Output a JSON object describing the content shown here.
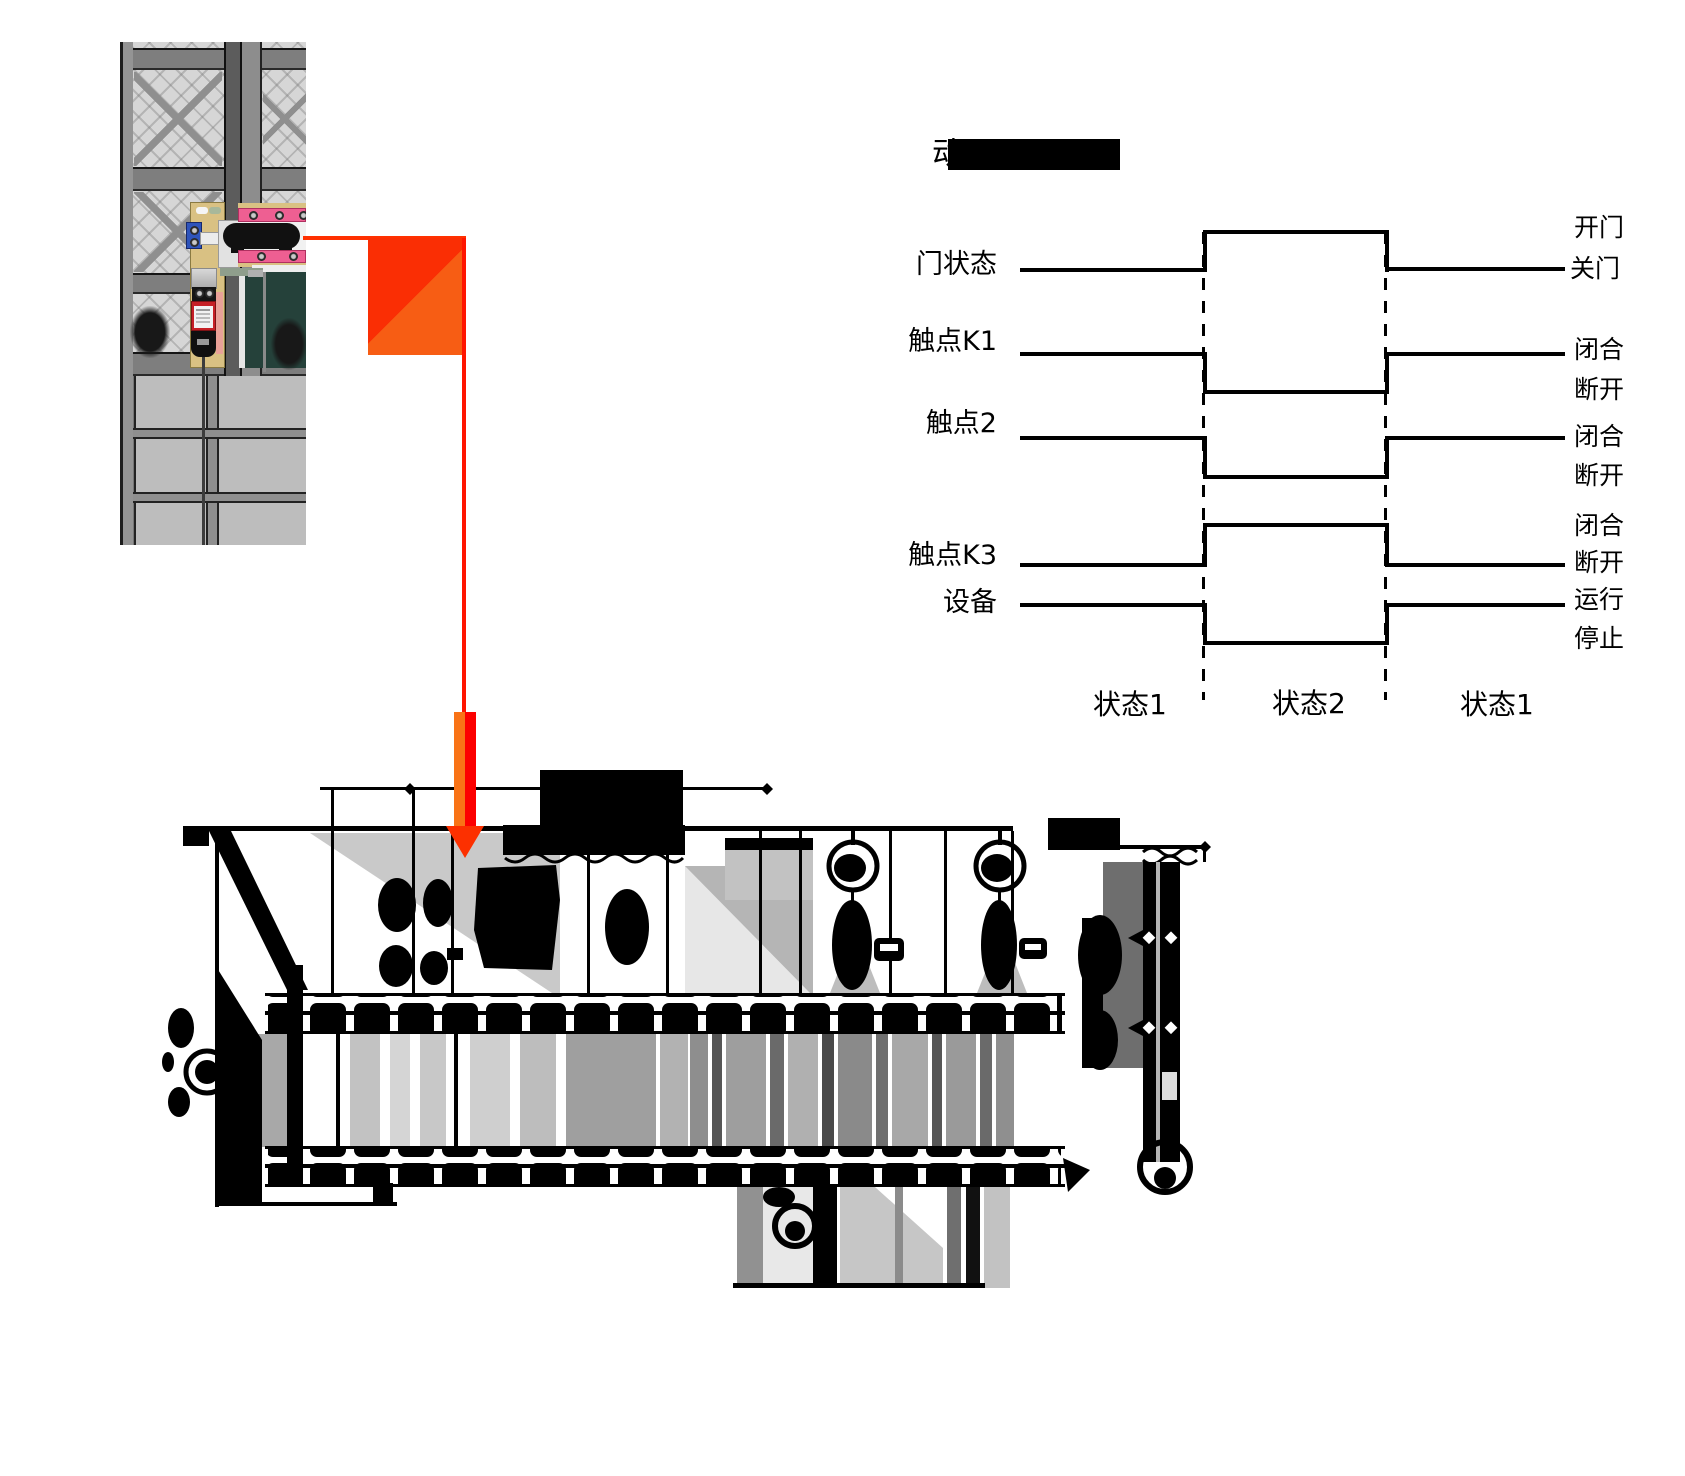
{
  "timing": {
    "title_visible_char": "动",
    "title_redacted": true,
    "signals": [
      {
        "label": "门状态",
        "upper": "开门",
        "lower": "关门"
      },
      {
        "label": "触点K1",
        "upper": "闭合",
        "lower": "断开"
      },
      {
        "label": "触点2",
        "upper": "闭合",
        "lower": "断开"
      },
      {
        "label": "触点K3",
        "upper": "闭合",
        "lower": "断开"
      },
      {
        "label": "设备",
        "upper": "运行",
        "lower": "停止"
      }
    ],
    "states": [
      {
        "label": "状态1"
      },
      {
        "label": "状态2"
      },
      {
        "label": "状态1"
      }
    ]
  },
  "colors": {
    "arrow_red": "#fa2e04",
    "arrow_orange": "#f75d14",
    "switch_body_red": "#c62026",
    "bracket_pink": "#ee5f92",
    "clamp_blue": "#2e54bb",
    "plate_tan": "#d9c183"
  }
}
